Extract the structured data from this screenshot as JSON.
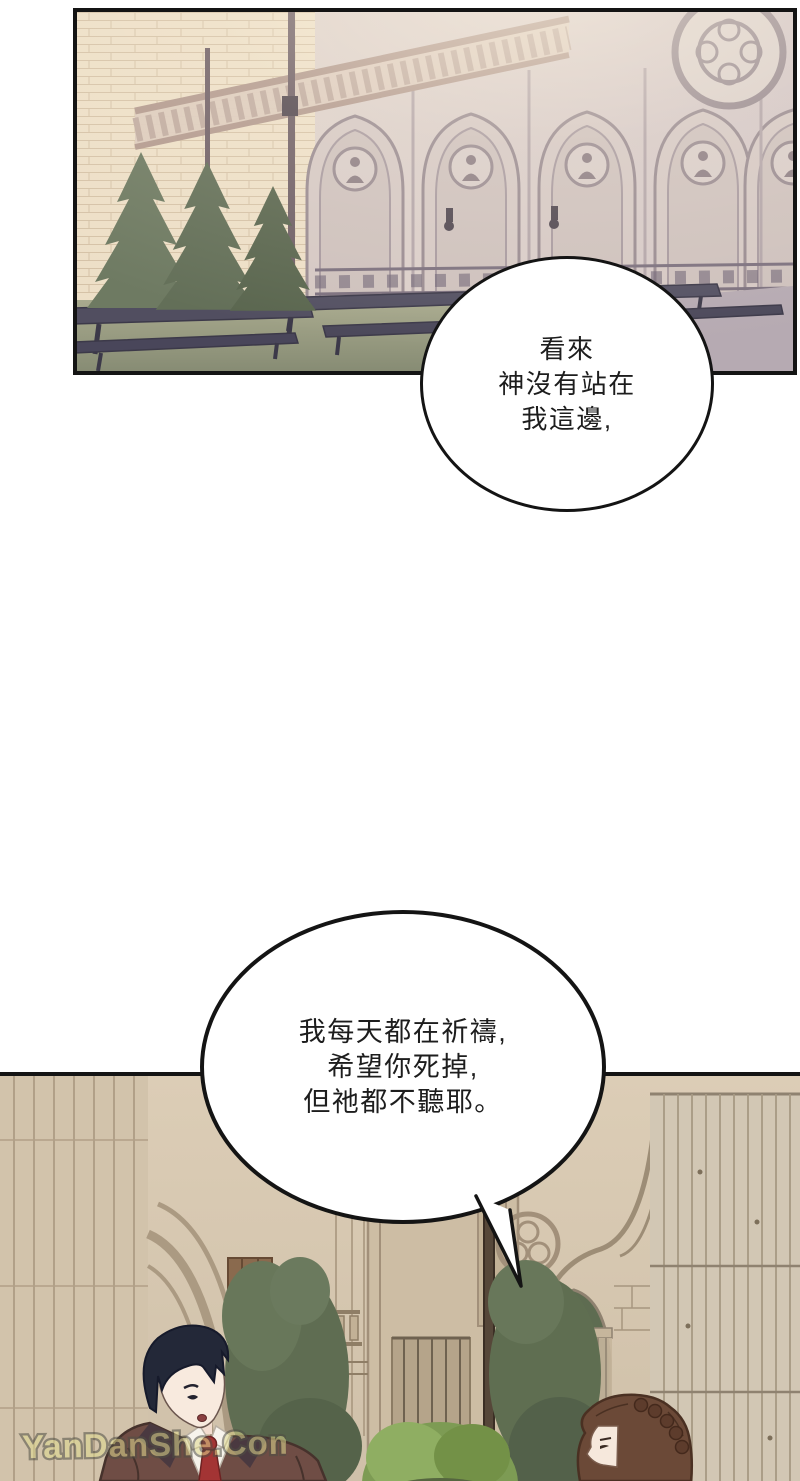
{
  "page": {
    "type": "manhwa-comic-page",
    "background_color": "#ffffff"
  },
  "scene": {
    "top_panel": "Gothic cathedral courtyard with balcony balustrade, pointed arcade, rose window, conifer trees and rows of dark benches on a lawn",
    "bottom_panel": "Gothic stone wall with arches, trees, a wooden plank wall, a dark-haired man in a brown coat with red tie and a brown-haired woman seen in profile"
  },
  "bubbles": [
    {
      "id": "speech-bubble-1",
      "lines": [
        "看來",
        "神沒有站在",
        "我這邊,"
      ]
    },
    {
      "id": "speech-bubble-2",
      "lines": [
        "我每天都在祈禱,",
        "希望你死掉,",
        "但祂都不聽耶。"
      ]
    }
  ],
  "watermark": {
    "text": "YanDanShe.Com",
    "fill_color": "#ded98e",
    "outline_color": "#504f44"
  },
  "palette": {
    "panel_border": "#141414",
    "brick_wall": "#ecdfc8",
    "gothic_wall": "#d3c6c6",
    "grass": "#8b9077",
    "bench": "#514e60",
    "stone_beige": "#d7c9b3",
    "foliage_dark": "#5f6d52",
    "foliage_bright": "#7d9b54",
    "man_hair": "#232838",
    "man_coat": "#6f4d45",
    "man_tie": "#a33434",
    "woman_hair": "#6b4937",
    "skin": "#f8eade"
  }
}
